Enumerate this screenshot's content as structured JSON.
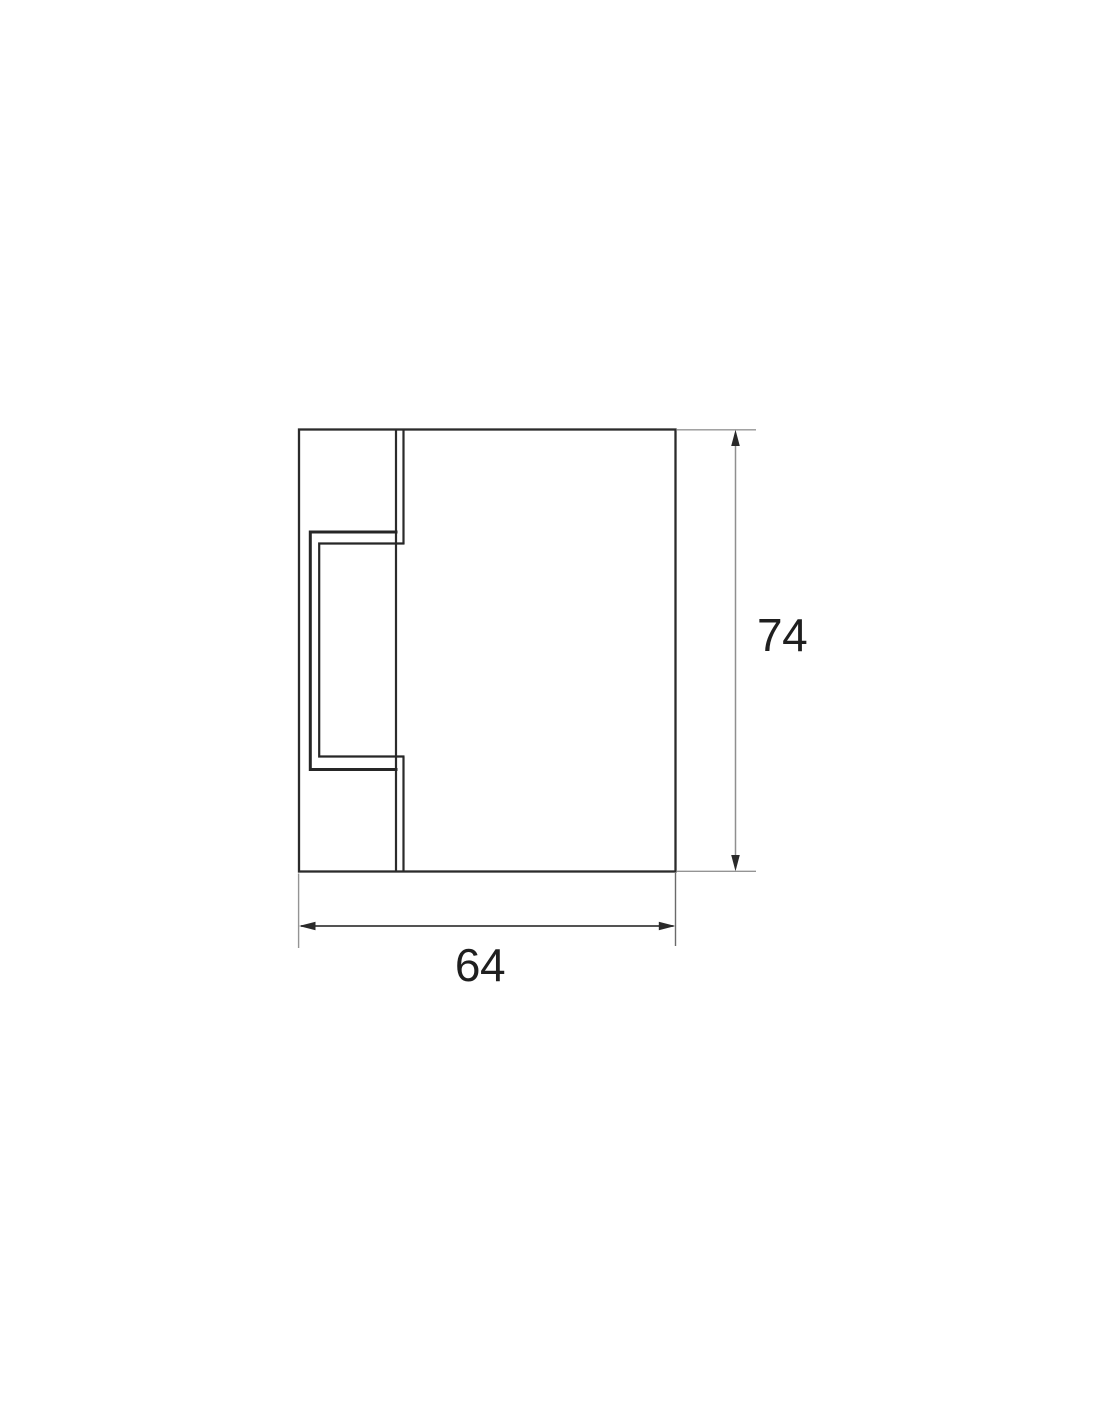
{
  "page": {
    "background_color": "#ffffff"
  },
  "drawing": {
    "kind": "2D technical dimension drawing (side profile with glass slot)",
    "dimensions": [
      {
        "id": "height",
        "value": "74",
        "orientation": "vertical",
        "position": "right"
      },
      {
        "id": "width",
        "value": "64",
        "orientation": "horizontal",
        "position": "bottom"
      }
    ],
    "colors": {
      "outline": "#2b2b2b",
      "slot_profile": "#262626",
      "extension_line": "#949494",
      "height_dimension_line": "#8f8f8f",
      "width_dimension_line": "#3c3c3c",
      "arrow": "#2a2a2a",
      "label_text": "#1f1f1f"
    }
  }
}
